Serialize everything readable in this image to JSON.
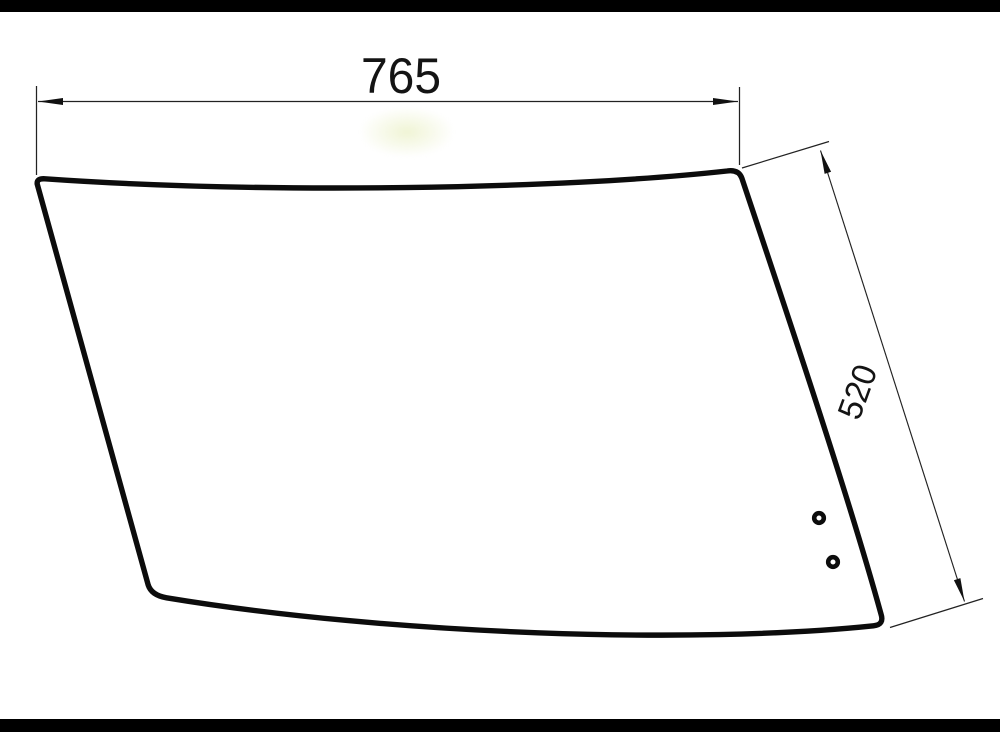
{
  "page": {
    "background_color": "#ffffff",
    "letterbox_color": "#000000"
  },
  "drawing": {
    "type": "technical-drawing",
    "subject": "curved glass panel (cab window) with two mounting holes",
    "line_color": "#0d0d0d",
    "thin_line_color": "#222222",
    "smudge_color": "#eef3d8",
    "holes_count": "2",
    "width_dimension": {
      "value": "765"
    },
    "height_dimension": {
      "value": "520"
    }
  }
}
